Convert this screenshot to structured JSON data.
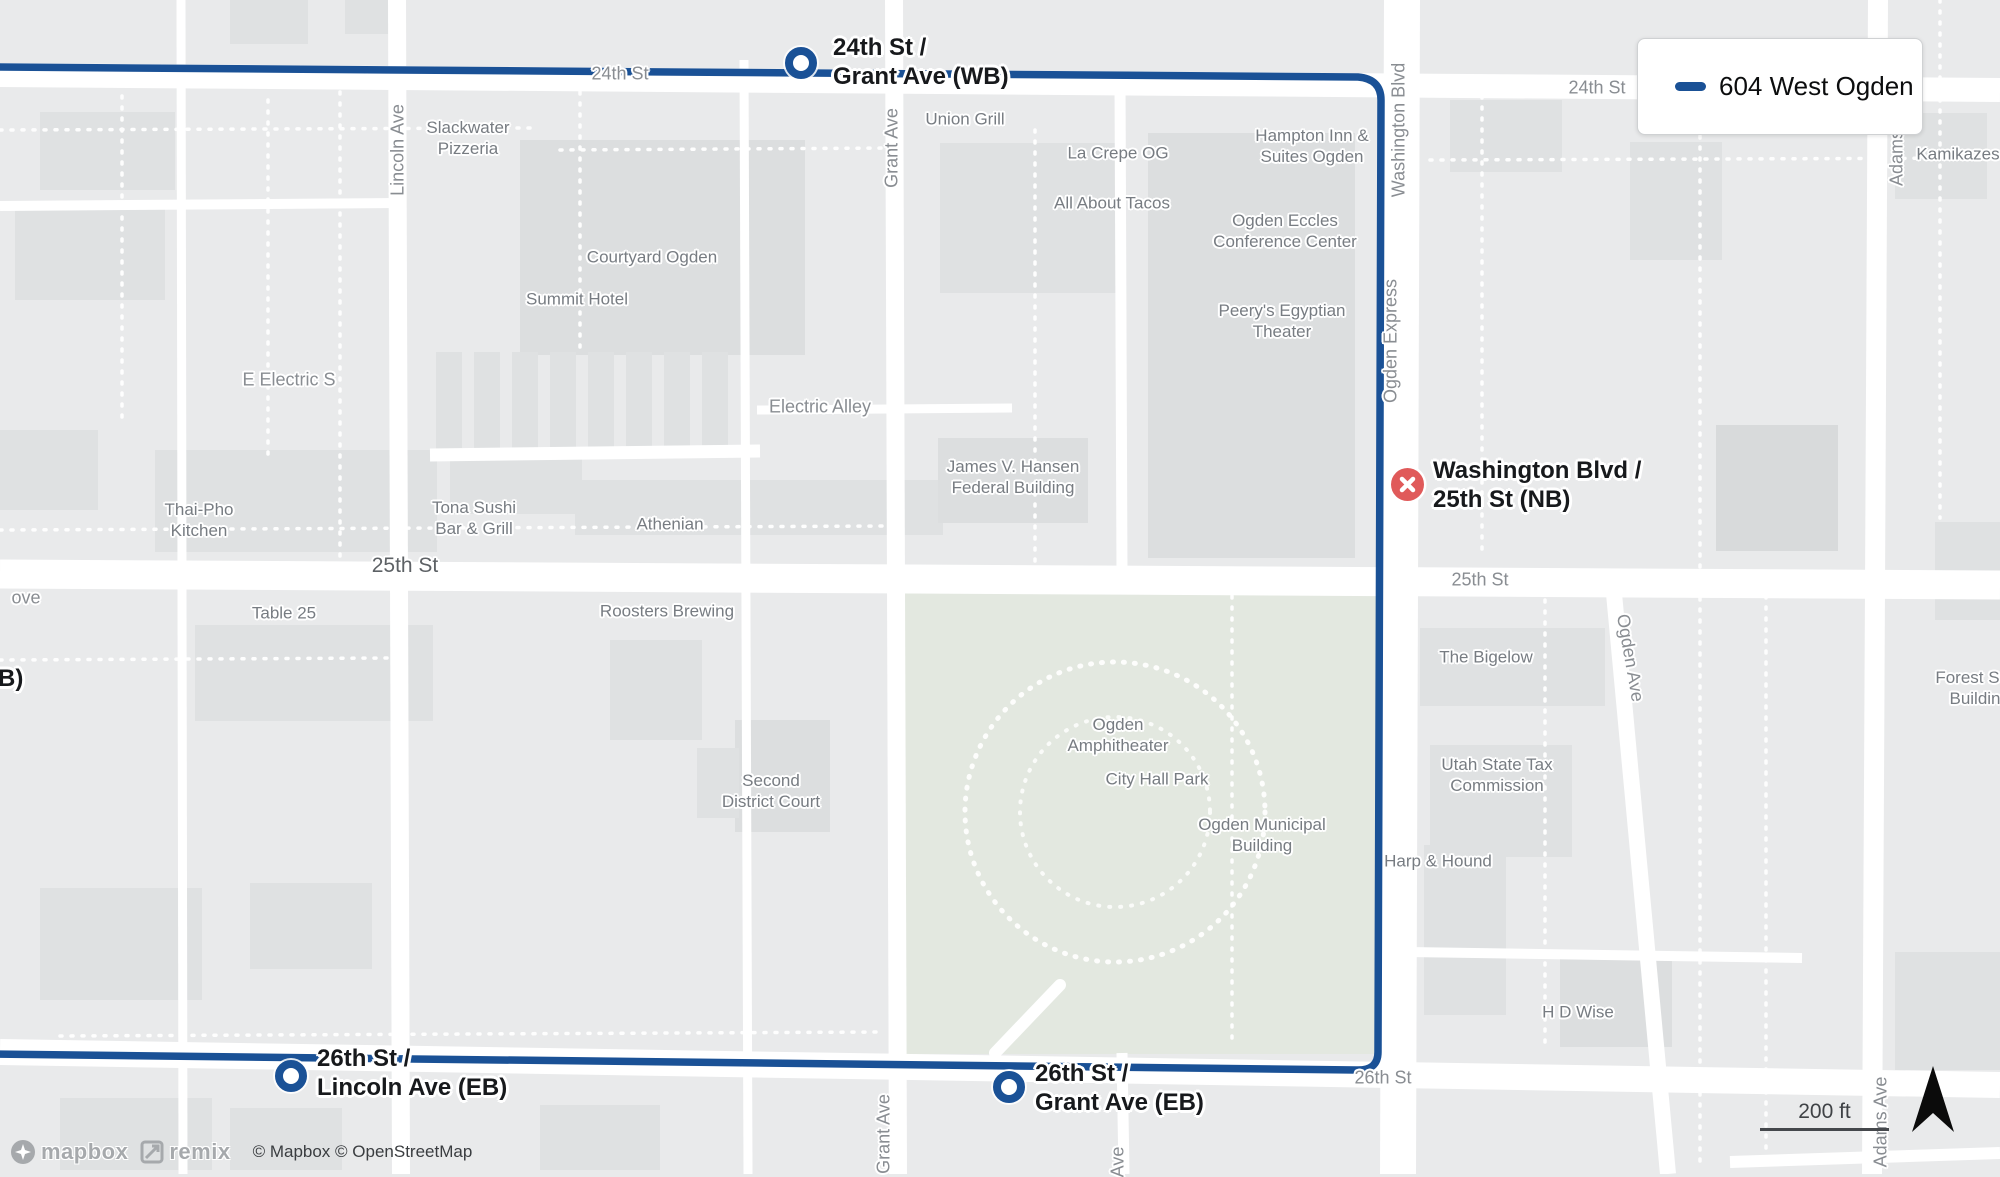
{
  "map": {
    "colors": {
      "route": "#1a5196",
      "error_marker": "#e05a5a",
      "land": "#e9eaeb",
      "building": "#dfe1e2",
      "park": "#e3e8e0",
      "road": "#ffffff"
    },
    "legend": {
      "route_label": "604 West Ogden"
    },
    "scale_bar": {
      "label": "200 ft"
    },
    "attribution": {
      "mapbox_wordmark": "mapbox",
      "remix_wordmark": "remix",
      "copyright": "© Mapbox © OpenStreetMap"
    },
    "stops": [
      {
        "id": "24th-st-grant-ave-wb",
        "marker": "circle",
        "lines": [
          "24th St /",
          "Grant Ave (WB)"
        ],
        "marker_x": 801,
        "marker_y": 63,
        "label_x": 833,
        "label_y": 33
      },
      {
        "id": "washington-blvd-25th-st-nb",
        "marker": "error",
        "lines": [
          "Washington Blvd /",
          "25th St (NB)"
        ],
        "marker_x": 1407,
        "marker_y": 484,
        "label_x": 1433,
        "label_y": 456
      },
      {
        "id": "26th-st-lincoln-ave-eb",
        "marker": "circle",
        "lines": [
          "26th St /",
          "Lincoln Ave (EB)"
        ],
        "marker_x": 291,
        "marker_y": 1076,
        "label_x": 317,
        "label_y": 1044
      },
      {
        "id": "26th-st-grant-ave-eb",
        "marker": "circle",
        "lines": [
          "26th St /",
          "Grant Ave (EB)"
        ],
        "marker_x": 1009,
        "marker_y": 1087,
        "label_x": 1035,
        "label_y": 1059
      },
      {
        "id": "edge-label-fragment",
        "marker": "none",
        "lines": [
          "B)"
        ],
        "marker_x": 0,
        "marker_y": 0,
        "label_x": -2,
        "label_y": 664
      }
    ],
    "street_labels": [
      {
        "text": "24th St",
        "cx": 620,
        "cy": 74
      },
      {
        "text": "24th St",
        "cx": 1597,
        "cy": 88
      },
      {
        "text": "25th St",
        "cx": 405,
        "cy": 566,
        "size": "lg"
      },
      {
        "text": "25th St",
        "cx": 1480,
        "cy": 580
      },
      {
        "text": "26th St",
        "cx": 1383,
        "cy": 1078
      },
      {
        "text": "Lincoln Ave",
        "cx": 398,
        "cy": 150,
        "rot": -90
      },
      {
        "text": "Grant Ave",
        "cx": 892,
        "cy": 148,
        "rot": -90
      },
      {
        "text": "Grant Ave",
        "cx": 884,
        "cy": 1134,
        "rot": -90
      },
      {
        "text": "Ave",
        "cx": 1118,
        "cy": 1162,
        "rot": -90
      },
      {
        "text": "Washington Blvd",
        "cx": 1399,
        "cy": 130,
        "rot": -90
      },
      {
        "text": "Ogden Express",
        "cx": 1391,
        "cy": 341,
        "rot": -90
      },
      {
        "text": "Ogden Ave",
        "cx": 1630,
        "cy": 658,
        "rot": 80
      },
      {
        "text": "Adams",
        "cx": 1897,
        "cy": 158,
        "rot": -90
      },
      {
        "text": "Adams Ave",
        "cx": 1881,
        "cy": 1122,
        "rot": -90
      },
      {
        "text": "Electric Alley",
        "cx": 820,
        "cy": 407
      },
      {
        "text": "E Electric S",
        "cx": 289,
        "cy": 380
      },
      {
        "text": "ove",
        "cx": 26,
        "cy": 598
      }
    ],
    "poi_labels": [
      {
        "lines": [
          "Slackwater",
          "Pizzeria"
        ],
        "cx": 468,
        "cy": 138
      },
      {
        "lines": [
          "Courtyard Ogden"
        ],
        "cx": 652,
        "cy": 257
      },
      {
        "lines": [
          "Summit Hotel"
        ],
        "cx": 577,
        "cy": 299
      },
      {
        "lines": [
          "Union Grill"
        ],
        "cx": 965,
        "cy": 119
      },
      {
        "lines": [
          "La Crepe OG"
        ],
        "cx": 1118,
        "cy": 153
      },
      {
        "lines": [
          "All About Tacos"
        ],
        "cx": 1112,
        "cy": 203
      },
      {
        "lines": [
          "Hampton Inn &",
          "Suites Ogden"
        ],
        "cx": 1312,
        "cy": 146
      },
      {
        "lines": [
          "Ogden Eccles",
          "Conference Center"
        ],
        "cx": 1285,
        "cy": 231
      },
      {
        "lines": [
          "Peery's Egyptian",
          "Theater"
        ],
        "cx": 1282,
        "cy": 321
      },
      {
        "lines": [
          "Thai-Pho",
          "Kitchen"
        ],
        "cx": 199,
        "cy": 520
      },
      {
        "lines": [
          "Tona Sushi",
          "Bar & Grill"
        ],
        "cx": 474,
        "cy": 518
      },
      {
        "lines": [
          "Athenian"
        ],
        "cx": 670,
        "cy": 524
      },
      {
        "lines": [
          "James V. Hansen",
          "Federal Building"
        ],
        "cx": 1013,
        "cy": 477
      },
      {
        "lines": [
          "Table 25"
        ],
        "cx": 284,
        "cy": 613
      },
      {
        "lines": [
          "Roosters Brewing"
        ],
        "cx": 667,
        "cy": 611
      },
      {
        "lines": [
          "Second",
          "District Court"
        ],
        "cx": 771,
        "cy": 791
      },
      {
        "lines": [
          "Ogden",
          "Amphitheater"
        ],
        "cx": 1118,
        "cy": 735
      },
      {
        "lines": [
          "City Hall Park"
        ],
        "cx": 1157,
        "cy": 779
      },
      {
        "lines": [
          "Ogden Municipal",
          "Building"
        ],
        "cx": 1262,
        "cy": 835
      },
      {
        "lines": [
          "The Bigelow"
        ],
        "cx": 1486,
        "cy": 657
      },
      {
        "lines": [
          "Utah State Tax",
          "Commission"
        ],
        "cx": 1497,
        "cy": 775
      },
      {
        "lines": [
          "Harp & Hound"
        ],
        "cx": 1438,
        "cy": 861
      },
      {
        "lines": [
          "H D Wise"
        ],
        "cx": 1578,
        "cy": 1012
      },
      {
        "lines": [
          "Forest Ser",
          "Buildin"
        ],
        "cx": 1975,
        "cy": 688
      },
      {
        "lines": [
          "Kamikazes"
        ],
        "cx": 1958,
        "cy": 154
      }
    ]
  }
}
